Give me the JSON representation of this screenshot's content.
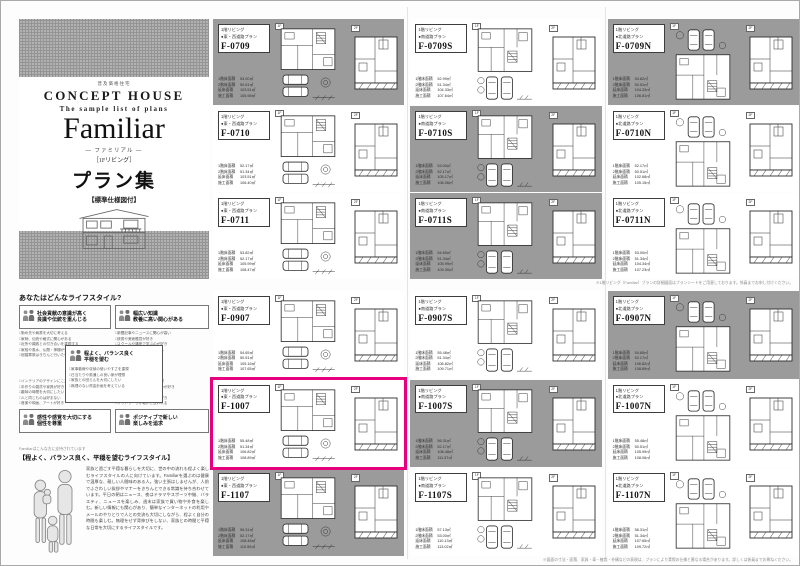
{
  "page": {
    "cover": {
      "tagline": "普及価格住宅",
      "brand": "CONCEPT HOUSE",
      "subtitle": "The sample list of plans",
      "series": "Familiar",
      "series_kana": "― ファミリアル ―",
      "series_note": "［1Fリビング］",
      "title": "プラン集",
      "spec_note": "【標準仕様図付】"
    },
    "lifestyle": {
      "title": "あなたはどんなライフスタイル?",
      "quadrants": [
        {
          "lines": [
            "社会貢献の意識が高く",
            "良識や伝統を重んじる"
          ],
          "items": [
            "□勤め先や肩書を大切に考える",
            "□家柄、伝統や格式に関心がある",
            "□近所や親戚との付き合いを重視する",
            "□家相や風水、仏間・神棚が気になる",
            "□冠婚葬祭はきちんと行いたい"
          ]
        },
        {
          "lines": [
            "幅広い知識",
            "教養に高い関心がある"
          ],
          "items": [
            "□新聞記事やニュースに関心が高い",
            "□読書や美術鑑賞が好き",
            "□スクールや講座で学ぶのが好き",
            "□子どもの教育環境を重視する",
            "□資格取得に興味がある"
          ]
        },
        {
          "lines": [
            "感性や感覚を大切にする",
            "個性を尊重"
          ],
          "items": [
            "□インテリアのデザインにこだわる",
            "□手作りの雑貨や家具が好き",
            "□趣味の時間を大切にしたい",
            "□人と同じものは好まない",
            "□音楽や映画、アートが好き"
          ]
        },
        {
          "lines": [
            "ポジティブで新しい",
            "楽しみを追求"
          ],
          "items": [
            "□新しい情報のチェックが日課",
            "□流行のスポットへ出かけるのが好き",
            "□ホームパーティーをよく開く",
            "□新しい家電やガジェットが好き",
            "□フットワークが軽いと言われる"
          ]
        }
      ],
      "center": {
        "lines": [
          "程よく、バランス良く",
          "平穏を望む"
        ],
        "items": [
          "□家事動線や収納の使いやすさを重視",
          "□日当たりや風通しの良い家が理想",
          "□家族との団らんを大切にしたい",
          "□無理のない資金計画を考えている"
        ]
      }
    },
    "recommend": {
      "lead": "Familiarはこんな方に支持されています",
      "heading": "【程よく、バランス良く、平穏を望むライフスタイル】",
      "body": "家族と過ごす平穏な暮らしを大切に、世の中の流れも程よく楽しむライフスタイルの人に向けています。Familiarを選ぶのは健康で温厚な、親しい人間味のある人。強い主張はしませんが、人前でふさわしい挨拶やマナーをきちんとできる常識を持ち合わせています。平日の朝はニュース、夜はドラマやスポーツ中継、バラエティ、ニュースを楽しみ、週末は家族で買い物や外食を楽しむ。新しい情報にも関心があり、簡単なインターネットの利用やメールのやりとりで人との交流も大切にしながら、程よく自分の時間も楽しむ。無理をせず背伸びをしない、家族との時間と平穏な日常を大切にするライフスタイルです。"
    },
    "plan_labels": {
      "living": "1階リビング",
      "floor1": "1F",
      "floor2": "2F",
      "stat_names": [
        "1階床面積",
        "2階床面積",
        "延床面積",
        "施工面積"
      ]
    },
    "blocks": {
      "top": {
        "caption": "※1階リビング（Familiar）プランの詳細図面はプランシートをご用意しております。係員までお申し付けください。",
        "rows": [
          [
            {
              "id": "F-0709",
              "road": "●東・西道路プラン",
              "bg": "gray",
              "variant": "h",
              "highlight": false,
              "stats": [
                "53.00㎡",
                "50.51㎡",
                "103.51㎡",
                "105.98㎡"
              ]
            },
            {
              "id": "F-0709S",
              "road": "●南道路プラン",
              "bg": "white",
              "variant": "v",
              "highlight": false,
              "stats": [
                "52.99㎡",
                "51.34㎡",
                "104.33㎡",
                "107.64㎡"
              ]
            },
            {
              "id": "F-0709N",
              "road": "●北道路プラン",
              "bg": "gray",
              "variant": "n",
              "highlight": false,
              "stats": [
                "53.82㎡",
                "50.51㎡",
                "104.33㎡",
                "106.81㎡"
              ]
            }
          ],
          [
            {
              "id": "F-0710",
              "road": "●東・西道路プラン",
              "bg": "white",
              "variant": "h",
              "highlight": false,
              "stats": [
                "52.17㎡",
                "51.34㎡",
                "103.51㎡",
                "106.40㎡"
              ]
            },
            {
              "id": "F-0710S",
              "road": "●南道路プラン",
              "bg": "gray",
              "variant": "v",
              "highlight": false,
              "stats": [
                "53.00㎡",
                "52.17㎡",
                "105.17㎡",
                "108.06㎡"
              ]
            },
            {
              "id": "F-0710N",
              "road": "●北道路プラン",
              "bg": "white",
              "variant": "n",
              "highlight": false,
              "stats": [
                "52.17㎡",
                "50.51㎡",
                "102.68㎡",
                "105.15㎡"
              ]
            }
          ],
          [
            {
              "id": "F-0711",
              "road": "●東・西道路プラン",
              "bg": "white",
              "variant": "h",
              "highlight": false,
              "stats": [
                "53.82㎡",
                "52.17㎡",
                "105.99㎡",
                "108.47㎡"
              ]
            },
            {
              "id": "F-0711S",
              "road": "●南道路プラン",
              "bg": "gray",
              "variant": "v",
              "highlight": false,
              "stats": [
                "54.65㎡",
                "51.34㎡",
                "105.99㎡",
                "109.30㎡"
              ]
            },
            {
              "id": "F-0711N",
              "road": "●北道路プラン",
              "bg": "white",
              "variant": "n",
              "highlight": false,
              "stats": [
                "53.00㎡",
                "51.34㎡",
                "104.34㎡",
                "107.23㎡"
              ]
            }
          ]
        ]
      },
      "bottom": {
        "caption": "※図面の寸法・面積、家具・車・植栽・外構などの表現は、プランにより実際の仕様と異なる場合があります。詳しくは係員までお尋ねください。",
        "rows": [
          [
            {
              "id": "F-0907",
              "road": "●東・西道路プラン",
              "bg": "white",
              "variant": "h",
              "highlight": false,
              "stats": [
                "54.65㎡",
                "50.51㎡",
                "105.16㎡",
                "107.65㎡"
              ]
            },
            {
              "id": "F-0907S",
              "road": "●南道路プラン",
              "bg": "white",
              "variant": "v",
              "highlight": false,
              "stats": [
                "55.48㎡",
                "51.34㎡",
                "106.82㎡",
                "109.71㎡"
              ]
            },
            {
              "id": "F-0907N",
              "road": "●北道路プラン",
              "bg": "gray",
              "variant": "n",
              "highlight": false,
              "stats": [
                "54.65㎡",
                "52.17㎡",
                "106.82㎡",
                "108.89㎡"
              ]
            }
          ],
          [
            {
              "id": "F-1007",
              "road": "●東・西道路プラン",
              "bg": "white",
              "variant": "h",
              "highlight": true,
              "stats": [
                "55.48㎡",
                "51.34㎡",
                "106.82㎡",
                "108.89㎡"
              ]
            },
            {
              "id": "F-1007S",
              "road": "●南道路プラン",
              "bg": "gray",
              "variant": "v",
              "highlight": false,
              "stats": [
                "56.31㎡",
                "52.17㎡",
                "108.48㎡",
                "111.37㎡"
              ]
            },
            {
              "id": "F-1007N",
              "road": "●北道路プラン",
              "bg": "white",
              "variant": "n",
              "highlight": false,
              "stats": [
                "55.48㎡",
                "50.51㎡",
                "105.99㎡",
                "108.06㎡"
              ]
            }
          ],
          [
            {
              "id": "F-1107",
              "road": "●東・西道路プラン",
              "bg": "gray",
              "variant": "h",
              "highlight": false,
              "stats": [
                "56.31㎡",
                "52.17㎡",
                "108.48㎡",
                "110.55㎡"
              ]
            },
            {
              "id": "F-1107S",
              "road": "●南道路プラン",
              "bg": "white",
              "variant": "v",
              "highlight": false,
              "stats": [
                "57.13㎡",
                "53.00㎡",
                "110.13㎡",
                "113.02㎡"
              ]
            },
            {
              "id": "F-1107N",
              "road": "●北道路プラン",
              "bg": "white",
              "variant": "n",
              "highlight": false,
              "stats": [
                "56.31㎡",
                "51.34㎡",
                "107.65㎡",
                "109.72㎡"
              ]
            }
          ]
        ]
      }
    },
    "colors": {
      "panel_gray": "#9b9b9b",
      "highlight_pink": "#e6007e"
    }
  }
}
